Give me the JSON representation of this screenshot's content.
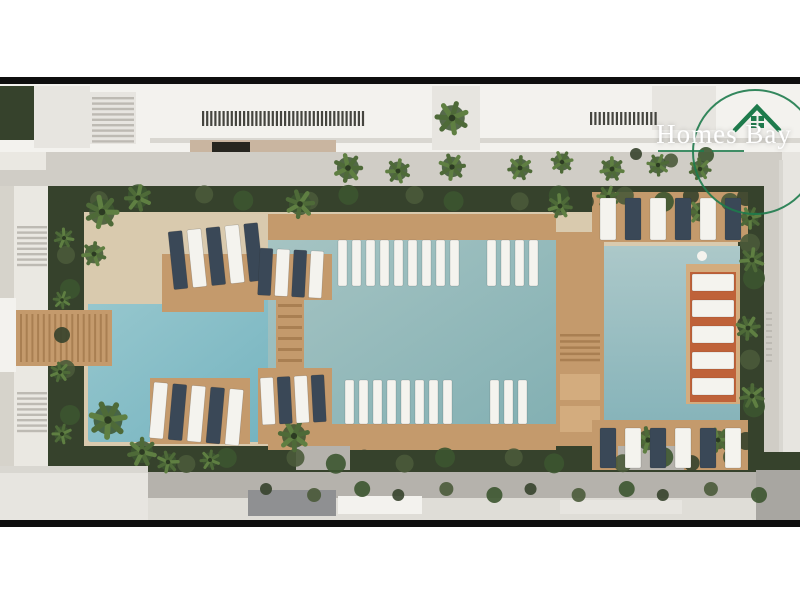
{
  "brand": {
    "name": "Homes Bay",
    "icon": "house-icon",
    "accent_color": "#1e7b4c",
    "text_color": "#ffffff"
  },
  "palette": {
    "page_bg": "#ffffff",
    "frame_bar": "#0e0e0e",
    "concrete": "#d6d3cb",
    "roof_white": "#f3f2ee",
    "roof_shadow": "#d9d7d1",
    "roof_light": "#e7e5e0",
    "louver": "#45453f",
    "wall_tan": "#c9b5a0",
    "car_dark": "#26251f",
    "promenade": "#d0cdc6",
    "path_white": "#eae8e2",
    "hedge_dark": "#36422c",
    "hedge_mid": "#4a5a3a",
    "palm_dark": "#3c5530",
    "palm_mid": "#4e6a38",
    "palm_light": "#5f7f42",
    "deck_sand": "#d9caae",
    "wood": "#c49a6c",
    "wood_light": "#d3ac7e",
    "plank_line": "#a97f52",
    "stair_line": "#bdbab3",
    "lounger_white": "#f4f3ee",
    "lounger_dark": "#3a4857",
    "lounger_orange": "#bf6239",
    "road": "#b5b2ac",
    "sidewalk": "#dfddd7",
    "building_gray": "#8f9092",
    "wall_right": "#a8a6a1",
    "water_l1": "#9ccad0",
    "water_l2": "#6fb0bd",
    "water_c1": "#a6c4c3",
    "water_c2": "#83b0b3",
    "water_r1": "#acc8c9",
    "water_r2": "#87b4ba",
    "logo_green": "#1e7b4c",
    "logo_text": "#ffffff"
  },
  "scene": {
    "description": "Top-down aerial rendering of a residential resort courtyard: three connected turquoise pools, wooden decks with sun loungers, in-pool loungers, palm trees, hedges, a promenade building at top and an access road at bottom",
    "palms": [
      {
        "x": 348,
        "y": 168,
        "r": 13
      },
      {
        "x": 398,
        "y": 171,
        "r": 11
      },
      {
        "x": 452,
        "y": 167,
        "r": 12
      },
      {
        "x": 520,
        "y": 168,
        "r": 11
      },
      {
        "x": 562,
        "y": 162,
        "r": 10
      },
      {
        "x": 612,
        "y": 169,
        "r": 11
      },
      {
        "x": 658,
        "y": 165,
        "r": 10
      },
      {
        "x": 700,
        "y": 169,
        "r": 10
      },
      {
        "x": 452,
        "y": 118,
        "r": 15
      },
      {
        "x": 102,
        "y": 212,
        "r": 15
      },
      {
        "x": 138,
        "y": 198,
        "r": 12
      },
      {
        "x": 300,
        "y": 204,
        "r": 13
      },
      {
        "x": 94,
        "y": 254,
        "r": 11
      },
      {
        "x": 108,
        "y": 420,
        "r": 17
      },
      {
        "x": 142,
        "y": 452,
        "r": 13
      },
      {
        "x": 294,
        "y": 436,
        "r": 14
      },
      {
        "x": 560,
        "y": 206,
        "r": 11
      },
      {
        "x": 608,
        "y": 197,
        "r": 10
      },
      {
        "x": 648,
        "y": 440,
        "r": 12
      },
      {
        "x": 700,
        "y": 212,
        "r": 11
      },
      {
        "x": 718,
        "y": 440,
        "r": 11
      },
      {
        "x": 752,
        "y": 260,
        "r": 11
      },
      {
        "x": 748,
        "y": 328,
        "r": 11
      },
      {
        "x": 752,
        "y": 396,
        "r": 11
      },
      {
        "x": 750,
        "y": 218,
        "r": 10
      },
      {
        "x": 64,
        "y": 238,
        "r": 9
      },
      {
        "x": 62,
        "y": 300,
        "r": 8
      },
      {
        "x": 60,
        "y": 372,
        "r": 9
      },
      {
        "x": 62,
        "y": 434,
        "r": 9
      },
      {
        "x": 168,
        "y": 462,
        "r": 10
      },
      {
        "x": 210,
        "y": 460,
        "r": 9
      }
    ],
    "lounger_groups": [
      {
        "name": "peninsula",
        "x": 168,
        "y": 232,
        "count": 5,
        "spacing": 19,
        "w": 14,
        "h": 58,
        "angle": -6,
        "colors": [
          "lounger_dark",
          "lounger_white"
        ]
      },
      {
        "name": "left-notch",
        "x": 154,
        "y": 382,
        "count": 5,
        "spacing": 19,
        "w": 14,
        "h": 56,
        "angle": 5,
        "colors": [
          "lounger_white",
          "lounger_dark"
        ]
      },
      {
        "name": "crossing-top",
        "x": 260,
        "y": 248,
        "count": 4,
        "spacing": 17,
        "w": 13,
        "h": 47,
        "angle": 3,
        "colors": [
          "lounger_dark",
          "lounger_white"
        ]
      },
      {
        "name": "crossing-bottom",
        "x": 260,
        "y": 378,
        "count": 4,
        "spacing": 17,
        "w": 13,
        "h": 47,
        "angle": -3,
        "colors": [
          "lounger_white",
          "lounger_dark"
        ]
      },
      {
        "name": "right-top-row",
        "x": 600,
        "y": 198,
        "count": 6,
        "spacing": 25,
        "w": 16,
        "h": 42,
        "angle": 0,
        "colors": [
          "lounger_white",
          "lounger_dark"
        ]
      },
      {
        "name": "right-bottom-row",
        "x": 600,
        "y": 428,
        "count": 6,
        "spacing": 25,
        "w": 16,
        "h": 40,
        "angle": 0,
        "colors": [
          "lounger_dark",
          "lounger_white"
        ]
      },
      {
        "name": "inpool-top-a",
        "x": 338,
        "y": 240,
        "count": 9,
        "spacing": 14,
        "w": 9,
        "h": 46,
        "angle": 0,
        "colors": [
          "lounger_white"
        ]
      },
      {
        "name": "inpool-top-b",
        "x": 487,
        "y": 240,
        "count": 4,
        "spacing": 14,
        "w": 9,
        "h": 46,
        "angle": 0,
        "colors": [
          "lounger_white"
        ]
      },
      {
        "name": "inpool-bottom-a",
        "x": 345,
        "y": 380,
        "count": 8,
        "spacing": 14,
        "w": 9,
        "h": 44,
        "angle": 0,
        "colors": [
          "lounger_white"
        ]
      },
      {
        "name": "inpool-bottom-b",
        "x": 490,
        "y": 380,
        "count": 3,
        "spacing": 14,
        "w": 9,
        "h": 44,
        "angle": 0,
        "colors": [
          "lounger_white"
        ]
      },
      {
        "name": "pier",
        "x": 692,
        "y": 274,
        "count": 5,
        "spacing": 26,
        "w": 42,
        "h": 17,
        "stack": "v",
        "angle": 0,
        "colors": [
          "lounger_white"
        ]
      }
    ],
    "stripes": [
      {
        "x": 202,
        "y": 111,
        "dir": "v",
        "count": 40,
        "step": 4.1,
        "len": 15,
        "w": 2.2,
        "color": "louver"
      },
      {
        "x": 590,
        "y": 112,
        "dir": "v",
        "count": 16,
        "step": 4.3,
        "len": 13,
        "w": 2.2,
        "color": "louver"
      },
      {
        "x": 92,
        "y": 97,
        "dir": "h",
        "count": 9,
        "step": 5.4,
        "len": 42,
        "w": 2.4,
        "color": "stair_line"
      },
      {
        "x": 17,
        "y": 226,
        "dir": "h",
        "count": 8,
        "step": 5.4,
        "len": 30,
        "w": 2.4,
        "color": "stair_line"
      },
      {
        "x": 17,
        "y": 392,
        "dir": "h",
        "count": 8,
        "step": 5.4,
        "len": 30,
        "w": 2.4,
        "color": "stair_line"
      },
      {
        "x": 20,
        "y": 314,
        "dir": "v",
        "count": 16,
        "step": 5.7,
        "len": 48,
        "w": 2,
        "color": "plank_line"
      },
      {
        "x": 278,
        "y": 304,
        "dir": "h",
        "count": 6,
        "step": 11,
        "len": 24,
        "w": 3,
        "color": "plank_line"
      },
      {
        "x": 560,
        "y": 334,
        "dir": "h",
        "count": 5,
        "step": 6.2,
        "len": 40,
        "w": 2.5,
        "color": "plank_line"
      },
      {
        "x": 766,
        "y": 312,
        "dir": "h",
        "count": 9,
        "step": 6,
        "len": 6,
        "w": 2,
        "color": "stair_line"
      }
    ],
    "bush_bands": [
      {
        "x1": 64,
        "y1": 197,
        "x2": 730,
        "y2": 199,
        "n": 20,
        "r": 8
      },
      {
        "x1": 150,
        "y1": 461,
        "x2": 732,
        "y2": 460,
        "n": 17,
        "r": 8
      },
      {
        "x1": 66,
        "y1": 212,
        "x2": 66,
        "y2": 452,
        "n": 7,
        "r": 8
      },
      {
        "x1": 750,
        "y1": 200,
        "x2": 750,
        "y2": 444,
        "n": 7,
        "r": 9
      },
      {
        "x1": 640,
        "y1": 157,
        "x2": 702,
        "y2": 158,
        "n": 3,
        "r": 6
      },
      {
        "x1": 270,
        "y1": 492,
        "x2": 755,
        "y2": 492,
        "n": 12,
        "r": 6
      }
    ]
  }
}
